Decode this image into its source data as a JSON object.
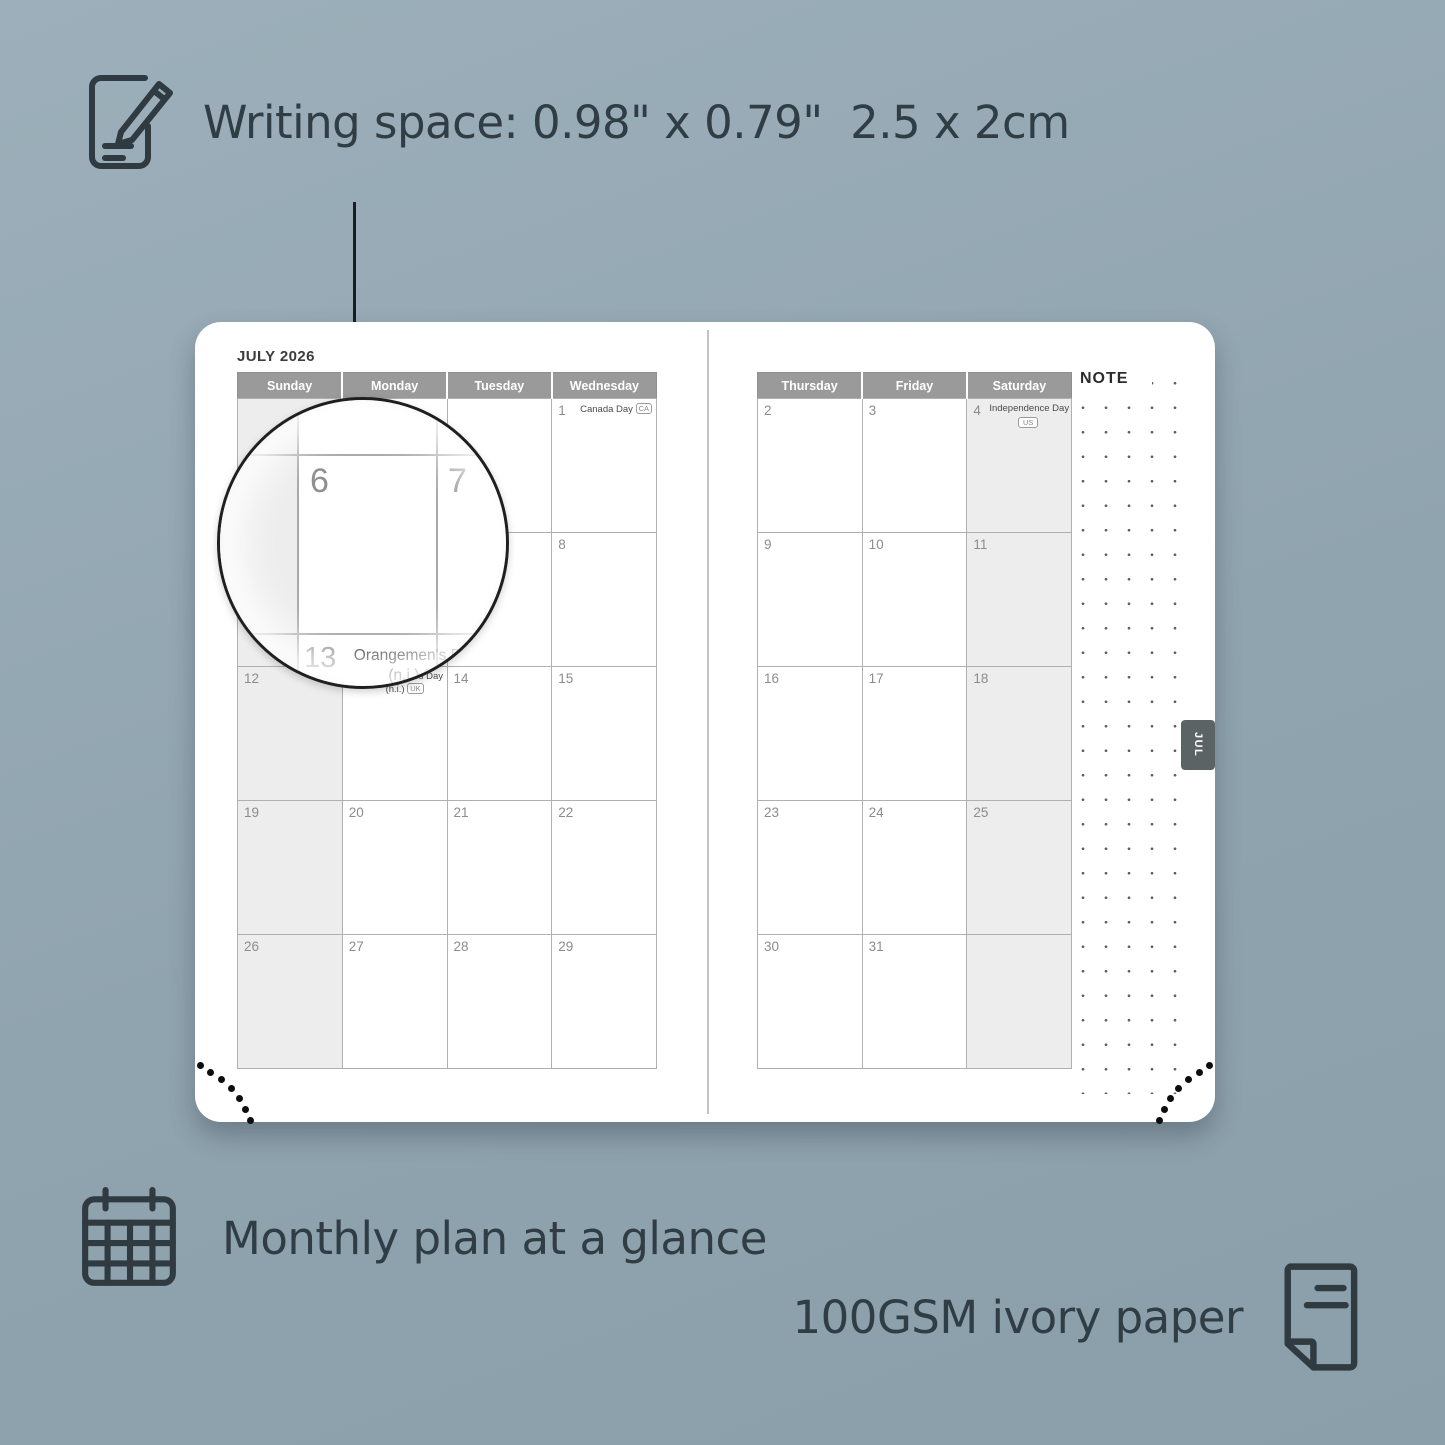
{
  "features": {
    "writing_space": "Writing space: 0.98\" x 0.79\"  2.5 x 2cm",
    "monthly_plan": "Monthly plan at a glance",
    "paper": "100GSM ivory paper"
  },
  "calendar": {
    "title": "JULY 2026",
    "note_label": "NOTE",
    "tab_label": "JUL",
    "left_headers": [
      "Sunday",
      "Monday",
      "Tuesday",
      "Wednesday"
    ],
    "right_headers": [
      "Thursday",
      "Friday",
      "Saturday"
    ],
    "left_weekend_col": 0,
    "right_weekend_col": 2,
    "left_rows": [
      [
        {},
        {},
        {},
        {
          "day": "1",
          "holiday": {
            "name": "Canada Day",
            "badge": "CA",
            "layout": "inline"
          }
        }
      ],
      [
        {},
        {},
        {},
        {
          "day": "8"
        }
      ],
      [
        {
          "day": "12"
        },
        {
          "day": "13",
          "holiday": {
            "name": "Orangemen's Day",
            "suffix": "(n.i.)",
            "badge": "UK",
            "layout": "twoline"
          }
        },
        {
          "day": "14"
        },
        {
          "day": "15"
        }
      ],
      [
        {
          "day": "19"
        },
        {
          "day": "20"
        },
        {
          "day": "21"
        },
        {
          "day": "22"
        }
      ],
      [
        {
          "day": "26"
        },
        {
          "day": "27"
        },
        {
          "day": "28"
        },
        {
          "day": "29"
        }
      ]
    ],
    "right_rows": [
      [
        {
          "day": "2"
        },
        {
          "day": "3"
        },
        {
          "day": "4",
          "holiday": {
            "name": "Independence Day",
            "badge": "US",
            "layout": "stacked"
          }
        }
      ],
      [
        {
          "day": "9"
        },
        {
          "day": "10"
        },
        {
          "day": "11"
        }
      ],
      [
        {
          "day": "16"
        },
        {
          "day": "17"
        },
        {
          "day": "18"
        }
      ],
      [
        {
          "day": "23"
        },
        {
          "day": "24"
        },
        {
          "day": "25"
        }
      ],
      [
        {
          "day": "30"
        },
        {
          "day": "31"
        },
        {}
      ]
    ]
  },
  "magnifier": {
    "day_a": "6",
    "day_b": "7",
    "day_c": "13",
    "holiday_name": "Orangemen's Day",
    "holiday_suffix": "(n.i.)",
    "holiday_badge": "UK"
  },
  "colors": {
    "background": "#90a4b0",
    "header_gray": "#9a9a9a",
    "weekend_shade": "#ededed",
    "tab_gray": "#5c6365",
    "text_dark": "#313d44"
  }
}
